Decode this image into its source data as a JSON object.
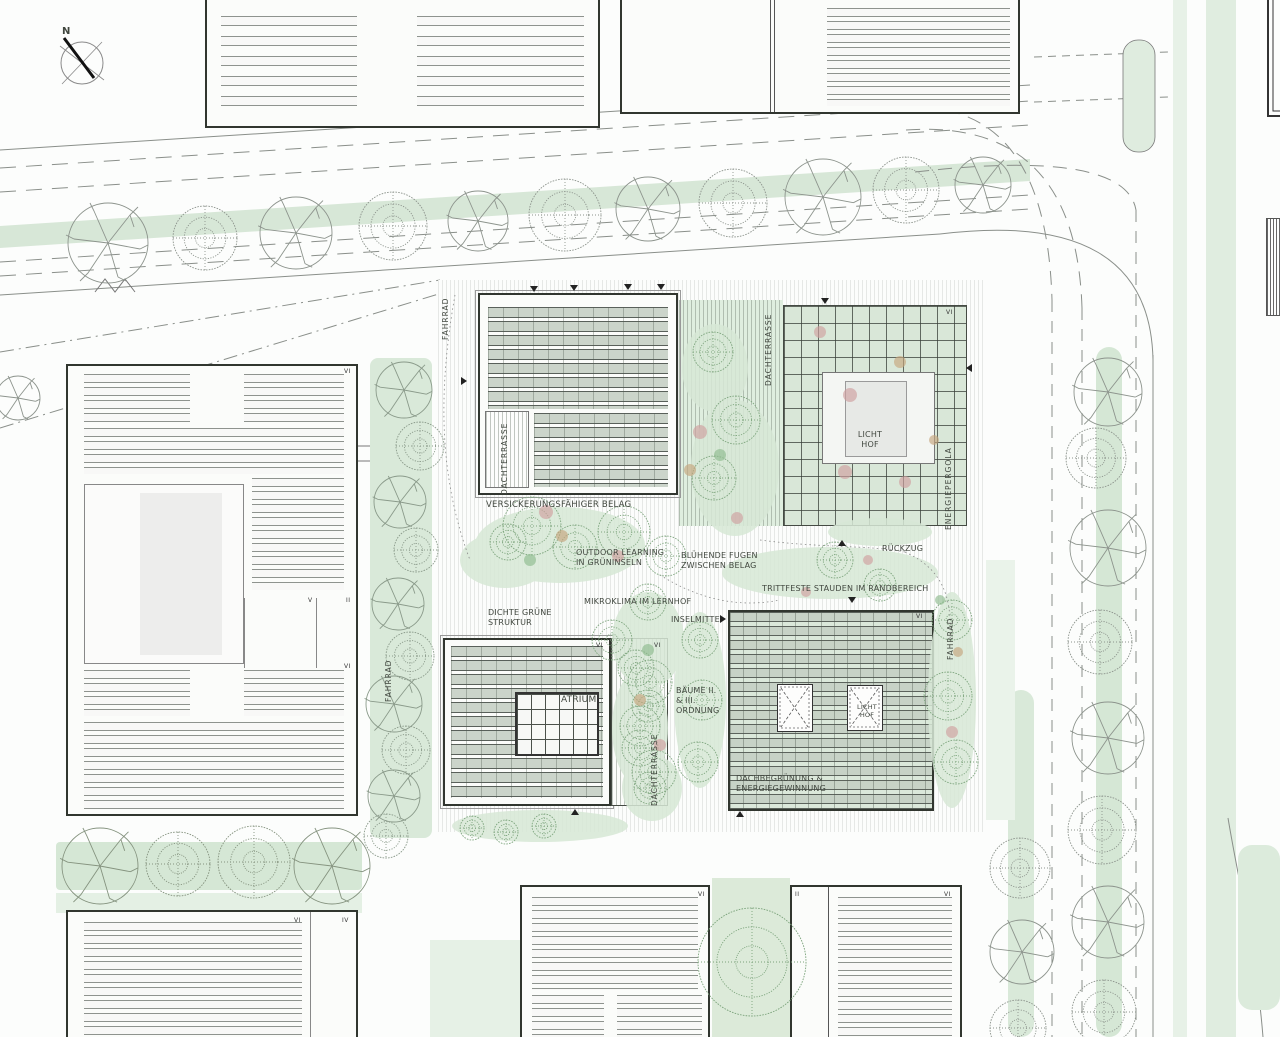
{
  "north": {
    "label": "N"
  },
  "labels": {
    "fahrrad": "FAHRRAD",
    "dachterrasse": "DACHTERRASSE",
    "versickerung": "VERSICKERUNGSFÄHIGER BELAG",
    "outdoor_learning": "OUTDOOR LEARNING\nIN GRÜNINSELN",
    "bluehende_fugen": "BLÜHENDE FUGEN\nZWISCHEN BELAG",
    "mikroklima": "MIKROKLIMA IM LERNHOF",
    "inselmitte": "INSELMITTE",
    "dichte_gruene": "DICHTE GRÜNE\nSTRUKTUR",
    "trittfeste": "TRITTFESTE STAUDEN IM RANDBEREICH",
    "rueckzug": "RÜCKZUG",
    "licht_hof": "LICHT\nHOF",
    "atrium": "ATRIUM",
    "energiepergola": "ENERGIEPERGOLA",
    "baeume": "BÄUME II.\n& III.\nORDNUNG",
    "dachbegruenung": "DACHBEGRÜNUNG &\nENERGIEGEWINNUNG"
  },
  "storeys": {
    "vi": "VI",
    "v": "V",
    "iv": "IV",
    "ii": "II"
  },
  "colors": {
    "green_wash": "#dcead9",
    "roof_green": "#d9e7d8",
    "panel_fill": "#cbd4ca",
    "line": "#3c423c",
    "accent_pink": "#d0a0a0",
    "accent_tan": "#c6a67e"
  }
}
